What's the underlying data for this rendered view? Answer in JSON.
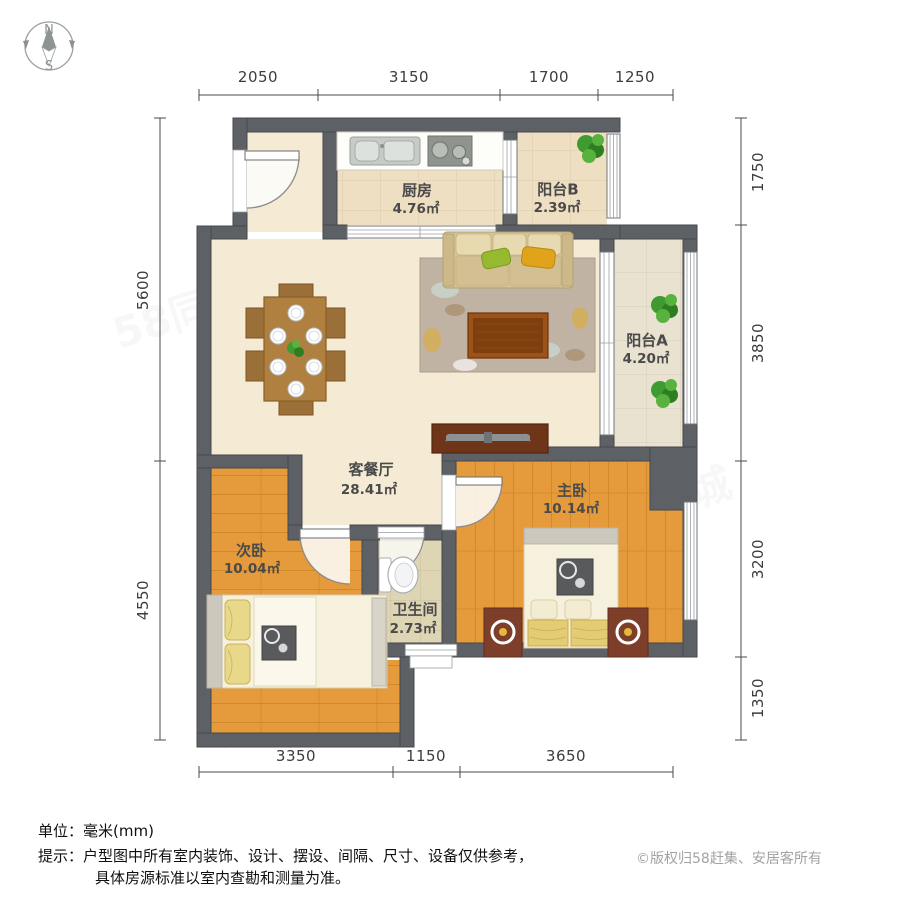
{
  "compass": {
    "north": "N",
    "south": "S"
  },
  "dimensions": {
    "top": [
      "2050",
      "3150",
      "1700",
      "1250"
    ],
    "bottom": [
      "3350",
      "1150",
      "3650"
    ],
    "left": [
      "5600",
      "4550"
    ],
    "right": [
      "1750",
      "3850",
      "3200",
      "1350"
    ]
  },
  "rooms": {
    "kitchen": {
      "name": "厨房",
      "area": "4.76㎡"
    },
    "balcony_b": {
      "name": "阳台B",
      "area": "2.39㎡"
    },
    "balcony_a": {
      "name": "阳台A",
      "area": "4.20㎡"
    },
    "living_dining": {
      "name": "客餐厅",
      "area": "28.41㎡"
    },
    "master_bedroom": {
      "name": "主卧",
      "area": "10.14㎡"
    },
    "second_bedroom": {
      "name": "次卧",
      "area": "10.04㎡"
    },
    "bathroom": {
      "name": "卫生间",
      "area": "2.73㎡"
    }
  },
  "footer": {
    "unit_label": "单位：毫米(mm)",
    "tip_line1": "提示：户型图中所有室内装饰、设计、摆设、间隔、尺寸、设备仅供参考，",
    "tip_line2": "具体房源标准以室内查勘和测量为准。",
    "copyright": "©版权归58赶集、安居客所有"
  },
  "watermark1": "58同城",
  "watermark2": "安居客",
  "colors": {
    "wall": "#5d6064",
    "floor_living": "#f5ead3",
    "floor_kitchen_tile": "#eedfc2",
    "floor_balcony_tile": "#e9e2d1",
    "floor_bath_tile": "#ddd5b4",
    "floor_wood": "#e59a3b",
    "sofa": "#d6c493",
    "pillow_green": "#96b930",
    "pillow_yellow": "#dfa31c",
    "table_wood": "#8a4316",
    "copyright_gray": "#a3a3a3"
  }
}
